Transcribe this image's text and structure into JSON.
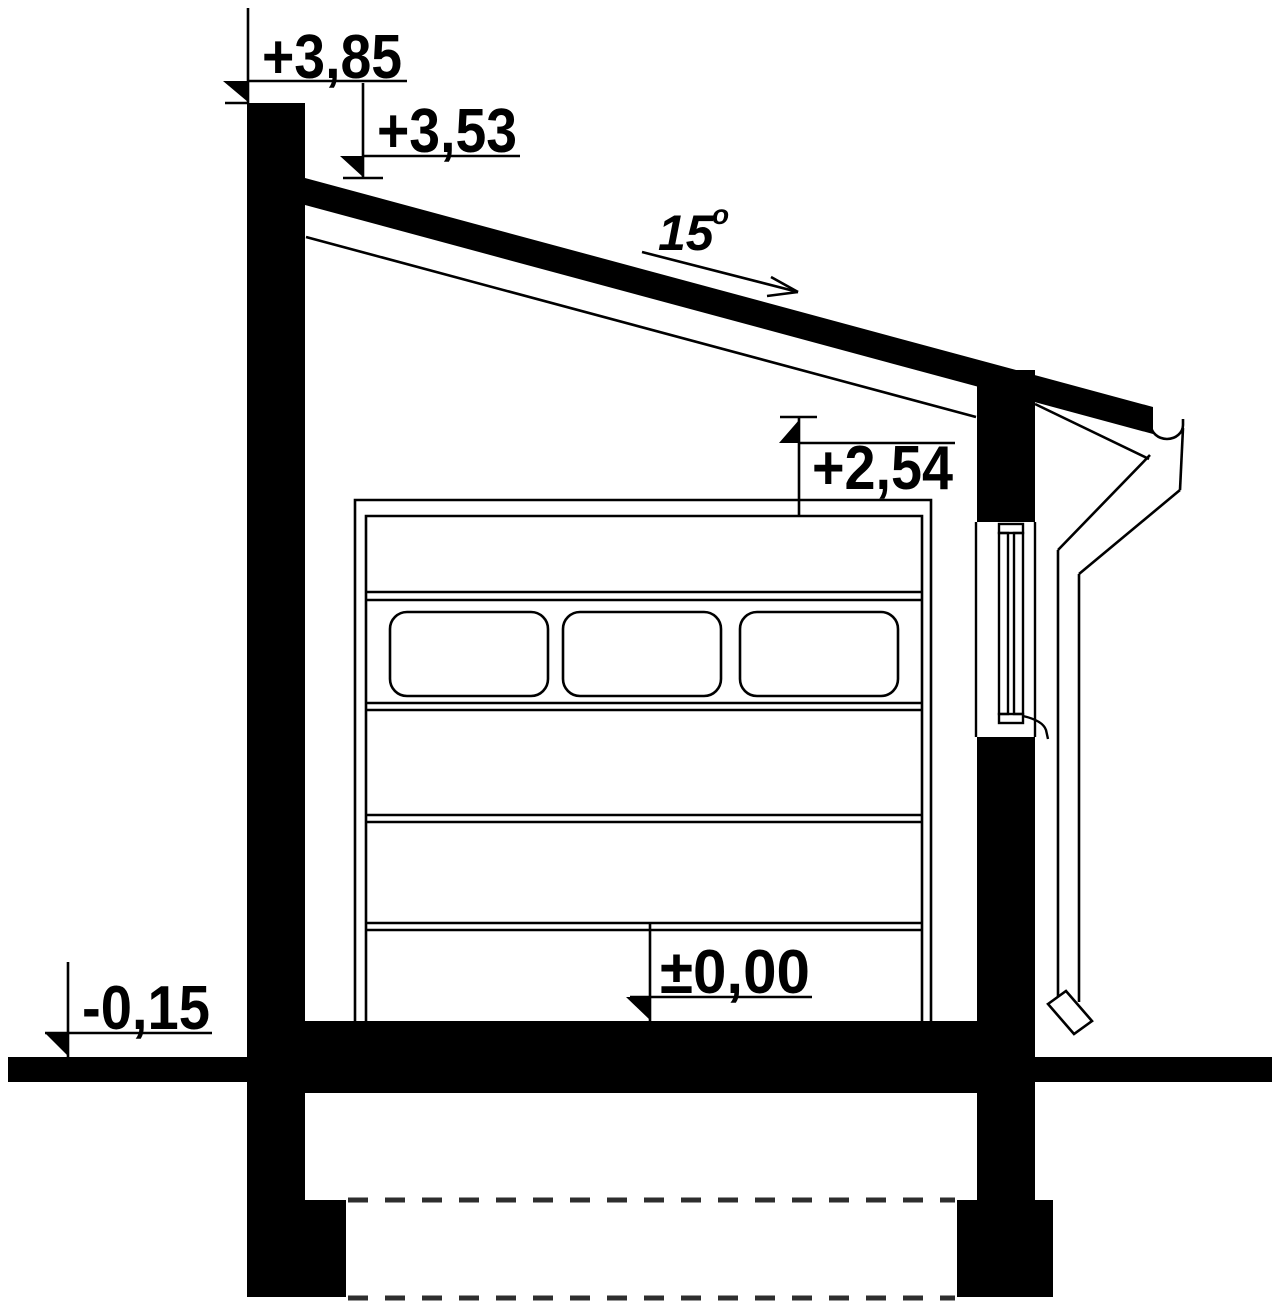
{
  "drawing": {
    "kind": "garage-cross-section",
    "colors": {
      "ink": "#000000",
      "paper": "#ffffff"
    }
  },
  "levels": {
    "parapet_top": "+3,85",
    "roof_eaves": "+3,53",
    "door_head": "+2,54",
    "floor": "±0,00",
    "exterior_ground": "-0,15"
  },
  "roof": {
    "slope_value": "15",
    "slope_degree_symbol": "o"
  }
}
